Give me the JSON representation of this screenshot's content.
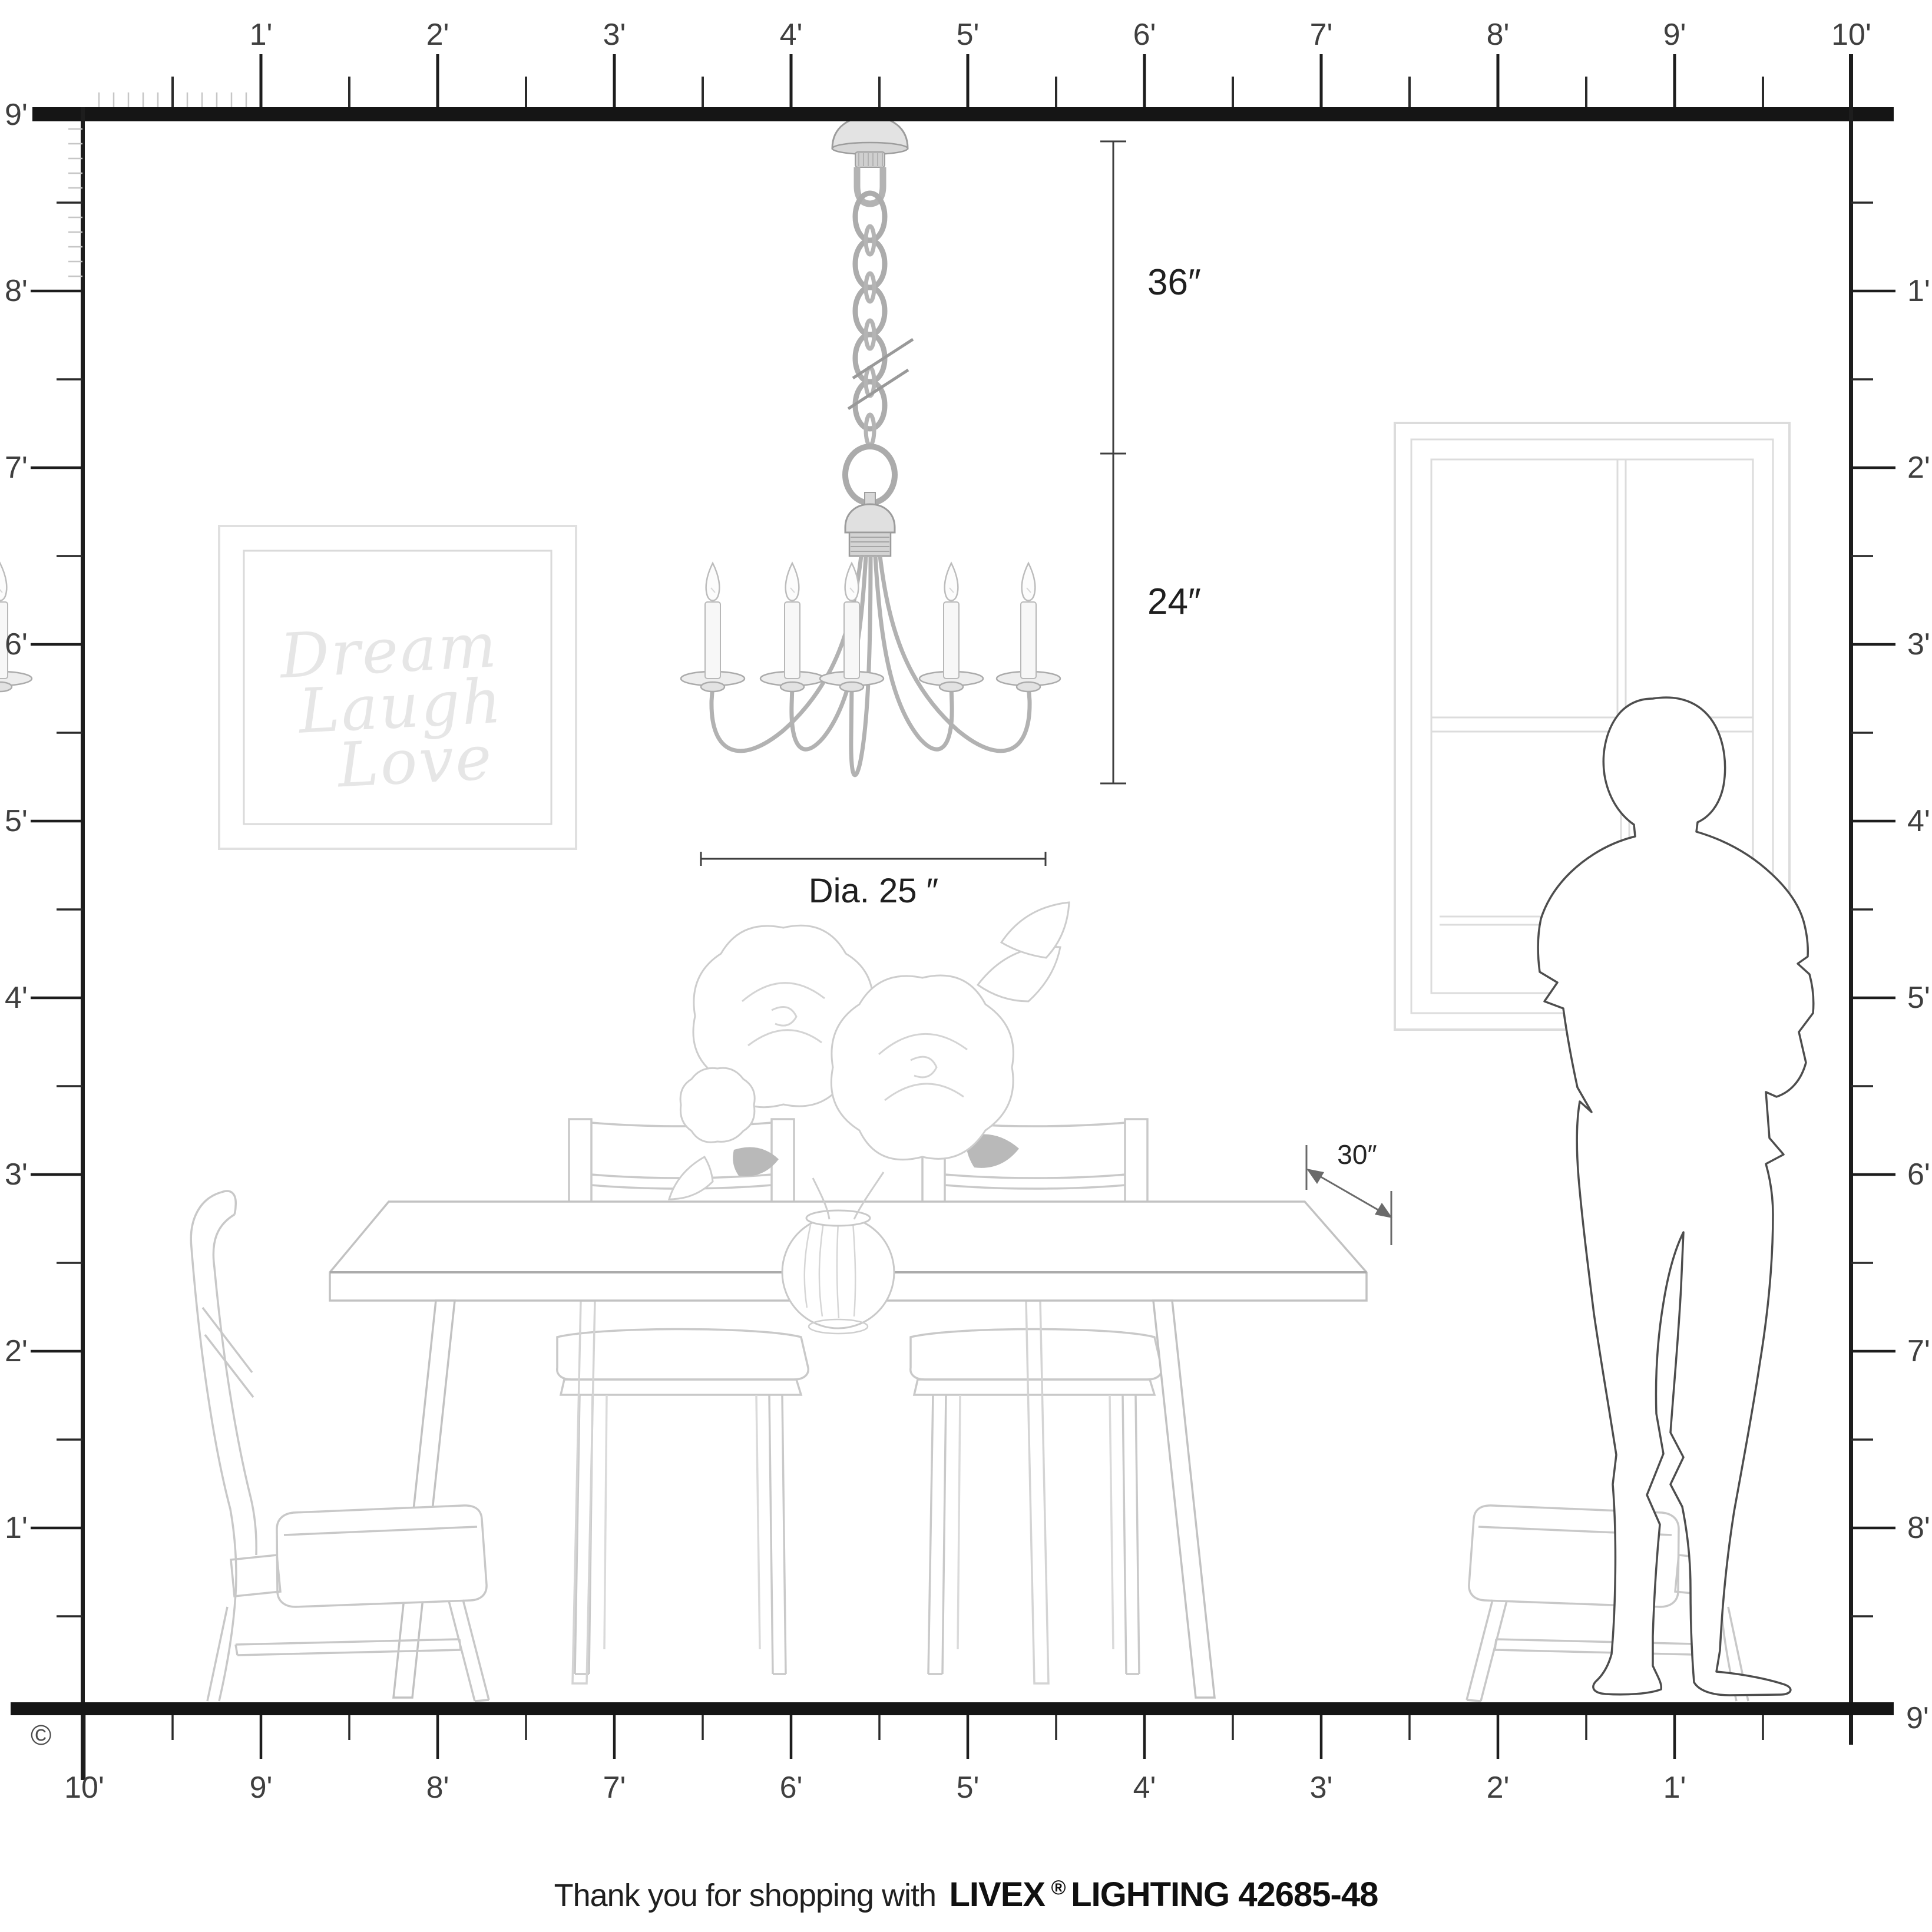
{
  "rulers": {
    "top": {
      "unit_labels": [
        "1'",
        "2'",
        "3'",
        "4'",
        "5'",
        "6'",
        "7'",
        "8'",
        "9'",
        "10'"
      ]
    },
    "left": {
      "unit_labels": [
        "9'",
        "8'",
        "7'",
        "6'",
        "5'",
        "4'",
        "3'",
        "2'",
        "1'"
      ]
    },
    "right": {
      "unit_labels": [
        "1'",
        "2'",
        "3'",
        "4'",
        "5'",
        "6'",
        "7'",
        "8'"
      ],
      "floor_label": "9'"
    },
    "bottom": {
      "unit_labels": [
        "10'",
        "9'",
        "8'",
        "7'",
        "6'",
        "5'",
        "4'",
        "3'",
        "2'",
        "1'"
      ]
    }
  },
  "annotations": {
    "chain_length": "36″",
    "fixture_height": "24″",
    "fixture_diameter": "Dia. 25 ″",
    "table_depth": "30″"
  },
  "wall_art": {
    "lines": [
      "Dream",
      "Laugh",
      "Love"
    ]
  },
  "footer": {
    "message": "Thank you for shopping with",
    "brand": "LIVEX",
    "registered_mark": "®",
    "brand_suffix": "LIGHTING 42685-48"
  },
  "copyright_symbol": "©",
  "colors": {
    "ruler_bar": "#151515",
    "ruler_label": "#3f3f3f",
    "dimension_line": "#3f3f3f",
    "dimension_text": "#1f1f1f",
    "furniture_line": "#c8c8c8",
    "window_line": "#dcdcdc",
    "wall_art_text": "#e6e6e6",
    "silhouette_line": "#4d4d4d",
    "chandelier_metal": "#ababab"
  }
}
